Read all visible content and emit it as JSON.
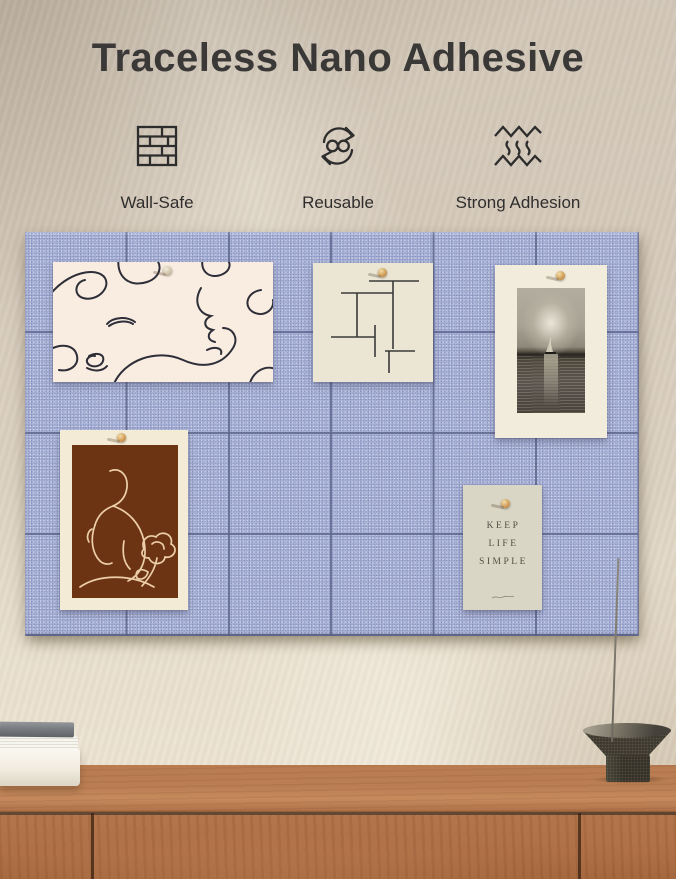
{
  "header": {
    "title": "Traceless Nano Adhesive"
  },
  "features": [
    {
      "label": "Wall-Safe",
      "icon": "brick-wall-icon"
    },
    {
      "label": "Reusable",
      "icon": "reusable-cycle-infinity-icon"
    },
    {
      "label": "Strong Adhesion",
      "icon": "strong-adhesion-zigzag-icon"
    }
  ],
  "board": {
    "name": "felt-tile-pin-board",
    "columns": 6,
    "rows": 4,
    "felt_color": "#a9b3d9",
    "seam_color": "#6e77a0"
  },
  "pinned_items": [
    {
      "name": "abstract-faces-line-art",
      "pin": "pale-push-pin"
    },
    {
      "name": "geometric-line-art-card",
      "pin": "wooden-push-pin"
    },
    {
      "name": "sailboat-seascape-photo",
      "pin": "wooden-push-pin"
    },
    {
      "name": "figure-and-flower-line-art",
      "pin": "wooden-push-pin"
    },
    {
      "name": "quote-card",
      "pin": "wooden-push-pin"
    }
  ],
  "quote_card": {
    "lines": [
      "KEEP",
      "LIFE",
      "SIMPLE"
    ]
  },
  "scene_props": {
    "left": "stack-of-books",
    "right": "stone-incense-holder-with-stick",
    "surface": "wooden-sideboard"
  },
  "palette": {
    "wall_top": "#d3c8b9",
    "wall_bottom": "#efe7d7",
    "felt": "#a9b3d9",
    "wood": "#b0714a",
    "card_cream": "#f2ebdb",
    "art_brown": "#6d3413",
    "text_dark": "#3a3938"
  }
}
